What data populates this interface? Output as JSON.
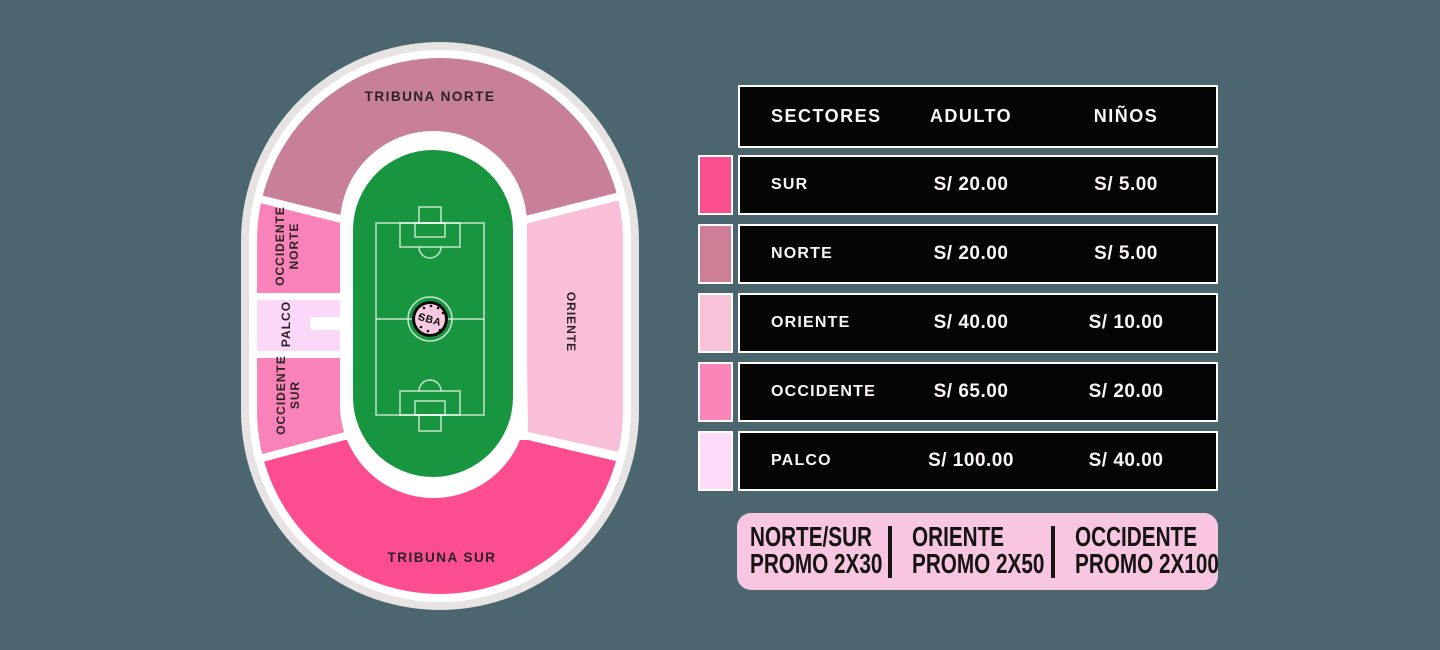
{
  "background_color": "#4C666F",
  "stadium": {
    "field_color": "#17953F",
    "logo_text": "SBA",
    "sections": {
      "tribuna_norte": {
        "label": "TRIBUNA NORTE",
        "color": "#C8809A"
      },
      "tribuna_sur": {
        "label": "TRIBUNA SUR",
        "color": "#FB4D90"
      },
      "occidente_norte": {
        "label_line1": "OCCIDENTE",
        "label_line2": "NORTE",
        "color": "#F983B8"
      },
      "occidente_sur": {
        "label_line1": "OCCIDENTE",
        "label_line2": "SUR",
        "color": "#F983B8"
      },
      "palco": {
        "label": "PALCO",
        "color": "#FBD8F8"
      },
      "oriente": {
        "label": "ORIENTE",
        "color": "#F9BFD9"
      }
    }
  },
  "table": {
    "headers": {
      "sectores": "SECTORES",
      "adulto": "ADULTO",
      "ninos": "NIÑOS"
    },
    "rows": [
      {
        "sector": "SUR",
        "adulto": "S/ 20.00",
        "ninos": "S/ 5.00",
        "color": "#FB4E8F"
      },
      {
        "sector": "NORTE",
        "adulto": "S/ 20.00",
        "ninos": "S/ 5.00",
        "color": "#CE7F96"
      },
      {
        "sector": "ORIENTE",
        "adulto": "S/ 40.00",
        "ninos": "S/ 10.00",
        "color": "#F8C2D8"
      },
      {
        "sector": "OCCIDENTE",
        "adulto": "S/ 65.00",
        "ninos": "S/ 20.00",
        "color": "#FB85B8"
      },
      {
        "sector": "PALCO",
        "adulto": "S/ 100.00",
        "ninos": "S/ 40.00",
        "color": "#FCDAF8"
      }
    ]
  },
  "promo": {
    "banner_color": "#F9C6E2",
    "items": [
      {
        "line1": "NORTE/SUR",
        "line2": "PROMO 2X30"
      },
      {
        "line1": "ORIENTE",
        "line2": "PROMO 2X50"
      },
      {
        "line1": "OCCIDENTE",
        "line2": "PROMO 2X100"
      }
    ]
  }
}
